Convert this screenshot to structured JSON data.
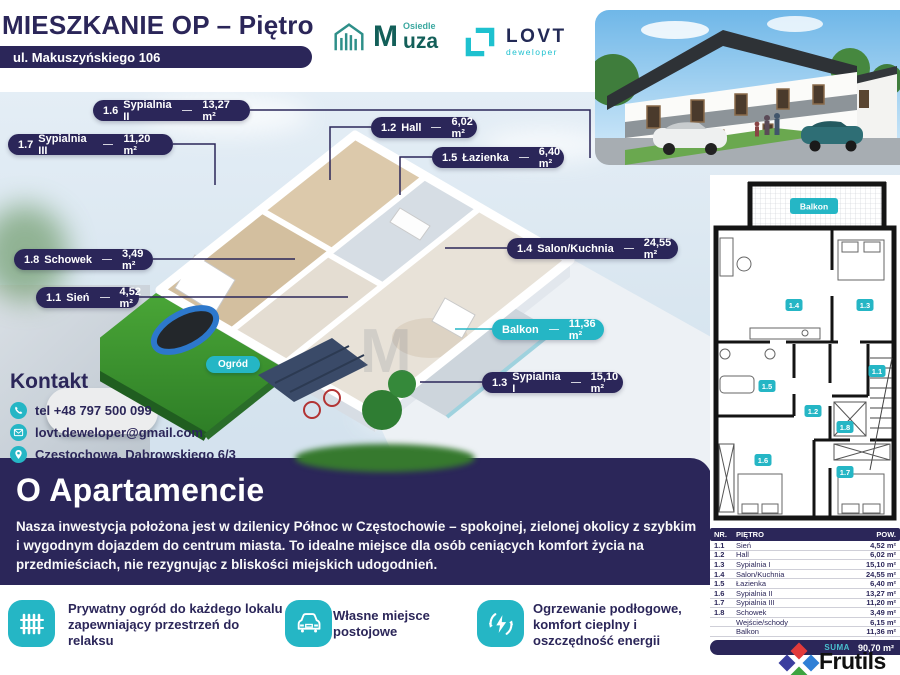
{
  "colors": {
    "navy": "#2b2659",
    "teal": "#25b6c5",
    "muza_green": "#135f59",
    "lovt_teal": "#1ec1cf"
  },
  "header": {
    "title": "MIESZKANIE OP – Piętro",
    "address": "ul. Makuszyńskiego 106"
  },
  "logos": {
    "muza": {
      "m": "M",
      "osiedle": "Osiedle",
      "uza": "uza"
    },
    "lovt": {
      "name": "LOVT",
      "sub": "deweloper"
    }
  },
  "callouts": {
    "c16": {
      "code": "1.6",
      "label": "Sypialnia II",
      "area": "13,27 m²"
    },
    "c17": {
      "code": "1.7",
      "label": "Sypialnia III",
      "area": "11,20 m²"
    },
    "c12": {
      "code": "1.2",
      "label": "Hall",
      "area": "6,02 m²"
    },
    "c15": {
      "code": "1.5",
      "label": "Łazienka",
      "area": "6,40 m²"
    },
    "c18": {
      "code": "1.8",
      "label": "Schowek",
      "area": "3,49 m²"
    },
    "c11": {
      "code": "1.1",
      "label": "Sień",
      "area": "4,52 m²"
    },
    "c14": {
      "code": "1.4",
      "label": "Salon/Kuchnia",
      "area": "24,55 m²"
    },
    "balkon": {
      "label": "Balkon",
      "area": "11,36 m²"
    },
    "c13": {
      "code": "1.3",
      "label": "Sypialnia I",
      "area": "15,10 m²"
    }
  },
  "garden": {
    "label": "Ogród"
  },
  "watermark": "M",
  "kontakt": {
    "heading": "Kontakt",
    "phone": "tel +48 797 500 099",
    "email": "lovt.deweloper@gmail.com",
    "address": "Częstochowa, Dąbrowskiego 6/3"
  },
  "about": {
    "heading": "O Apartamencie",
    "body": "Nasza inwestycja położona jest w dzilenicy Północ w Częstochowie – spokojnej, zielonej okolicy z szybkim i wygodnym dojazdem do centrum miasta. To idealne miejsce dla osób ceniących komfort życia na przedmieściach, nie rezygnując z bliskości miejskich udogodnień."
  },
  "features": {
    "f1": {
      "text": "Prywatny ogród do każdego lokalu zapewniający przestrzeń do relaksu"
    },
    "f2": {
      "text": "Własne miejsce postojowe"
    },
    "f3": {
      "text": "Ogrzewanie podłogowe, komfort cieplny i oszczędność energii"
    }
  },
  "plan2d": {
    "balkon": "Balkon",
    "r11": "1.1",
    "r12": "1.2",
    "r13": "1.3",
    "r14": "1.4",
    "r15": "1.5",
    "r16": "1.6",
    "r17": "1.7",
    "r18": "1.8"
  },
  "table": {
    "headers": {
      "nr": "NR.",
      "floor": "PIĘTRO",
      "pow": "POW."
    },
    "rows": [
      {
        "nr": "1.1",
        "name": "Sień",
        "area": "4,52 m²"
      },
      {
        "nr": "1.2",
        "name": "Hall",
        "area": "6,02 m²"
      },
      {
        "nr": "1.3",
        "name": "Sypialnia I",
        "area": "15,10 m²"
      },
      {
        "nr": "1.4",
        "name": "Salon/Kuchnia",
        "area": "24,55 m²"
      },
      {
        "nr": "1.5",
        "name": "Łazienka",
        "area": "6,40 m²"
      },
      {
        "nr": "1.6",
        "name": "Sypialnia II",
        "area": "13,27 m²"
      },
      {
        "nr": "1.7",
        "name": "Sypialnia III",
        "area": "11,20 m²"
      },
      {
        "nr": "1.8",
        "name": "Schowek",
        "area": "3,49 m²"
      },
      {
        "nr": "",
        "name": "Wejście/schody",
        "area": "6,15 m²"
      },
      {
        "nr": "",
        "name": "Balkon",
        "area": "11,36 m²"
      }
    ],
    "suma_label": "SUMA",
    "suma_value": "90,70 m²"
  },
  "brand": {
    "name": "Frutils"
  }
}
